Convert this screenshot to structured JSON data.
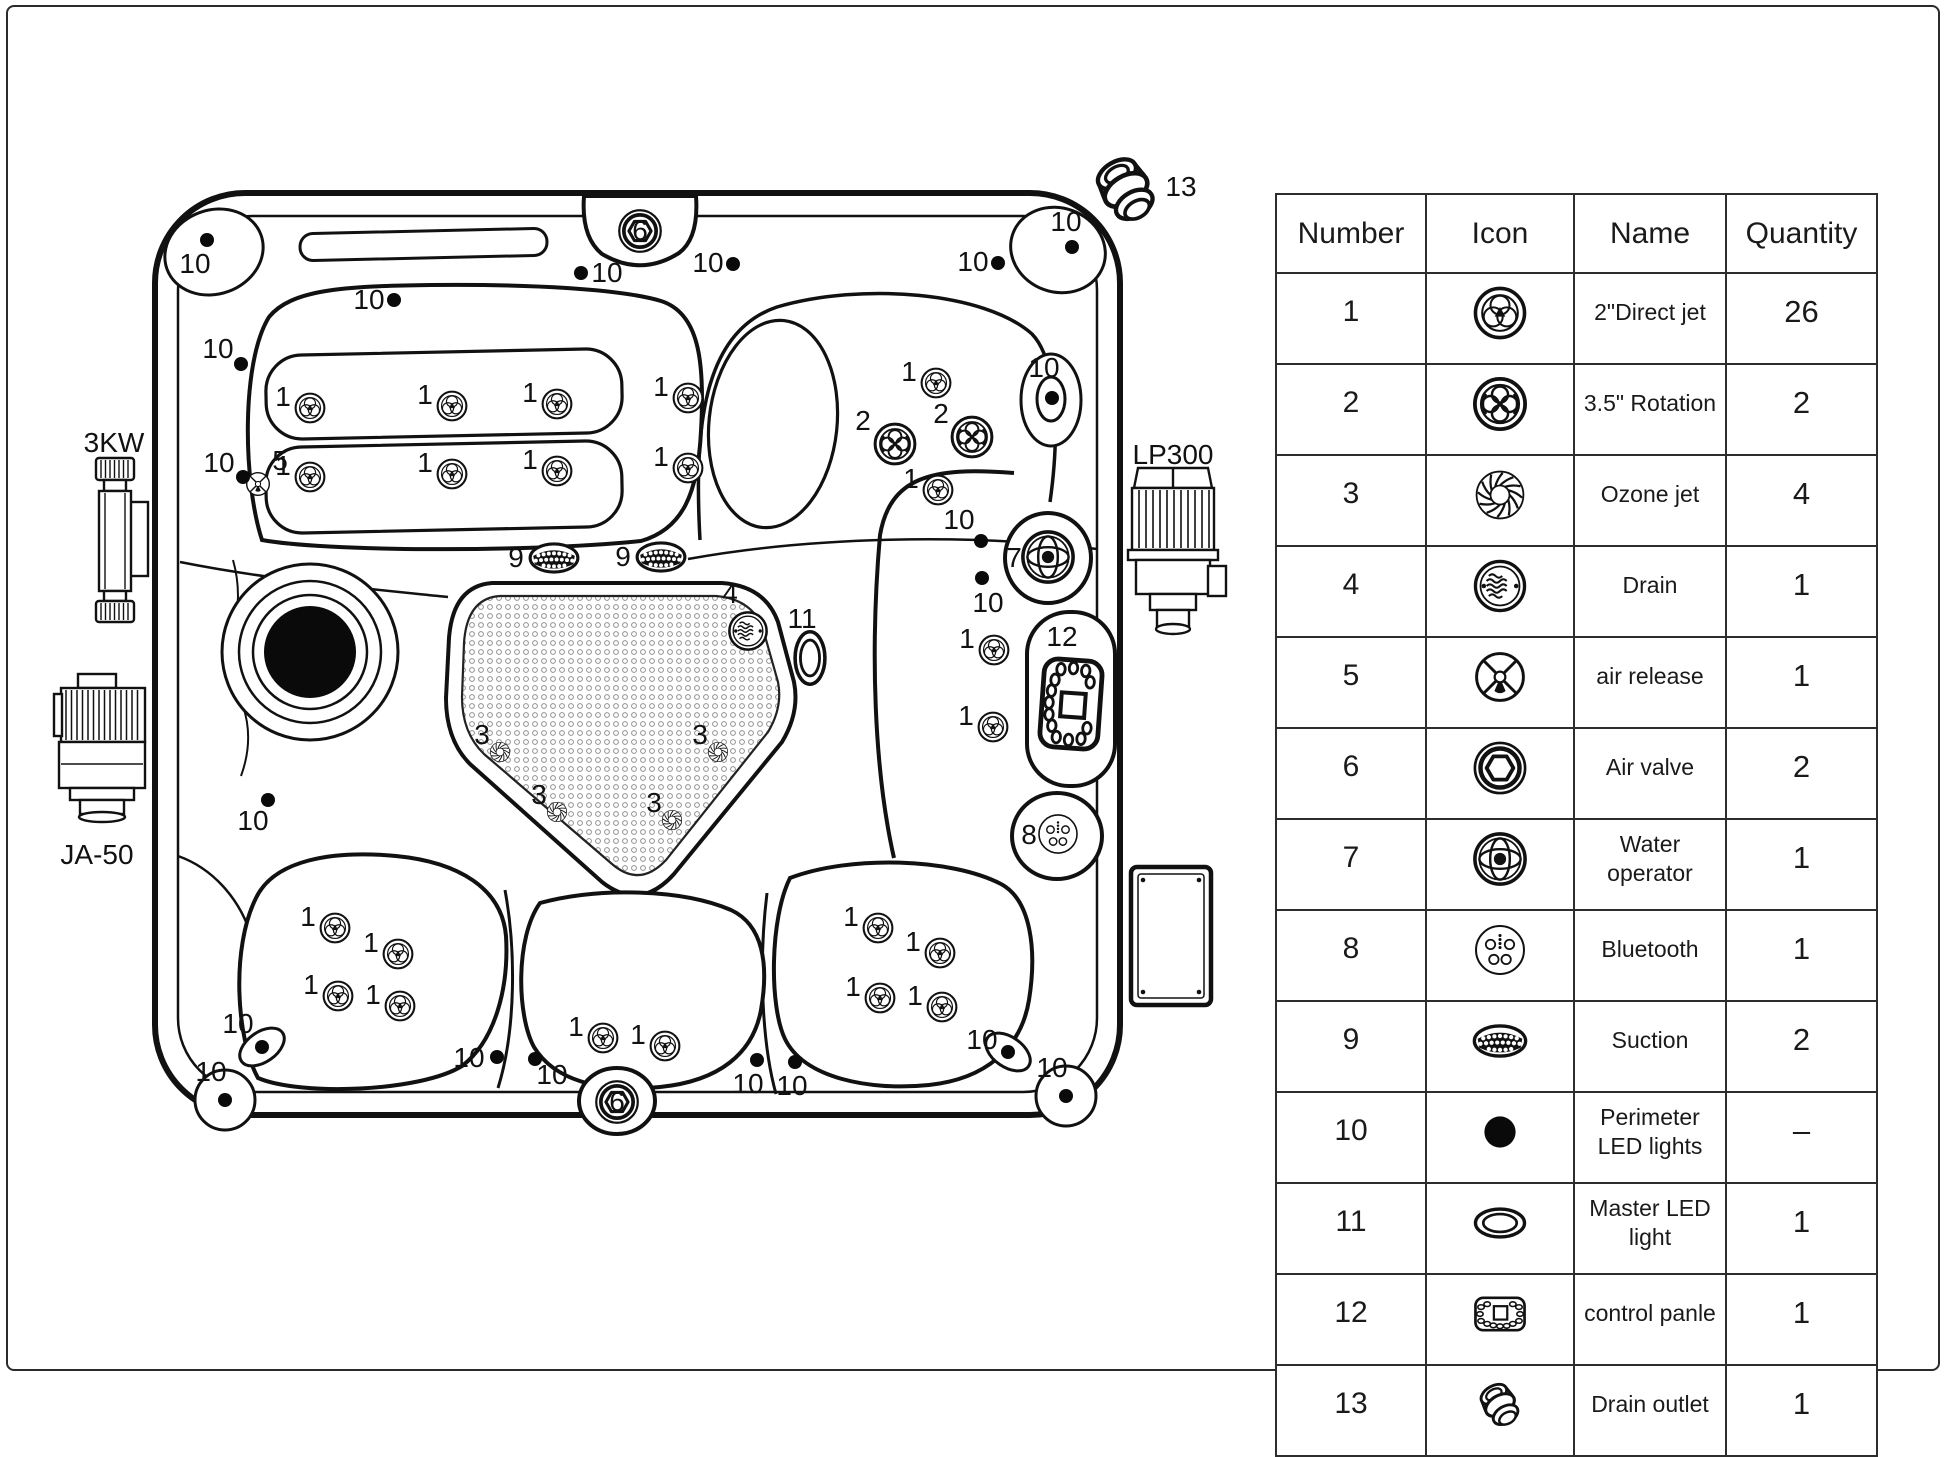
{
  "table": {
    "headers": [
      "Number",
      "Icon",
      "Name",
      "Quantity"
    ],
    "rows": [
      {
        "number": "1",
        "icon": "jet1",
        "name": "2\"Direct jet",
        "qty": "26"
      },
      {
        "number": "2",
        "icon": "jet2",
        "name": "3.5\" Rotation",
        "qty": "2"
      },
      {
        "number": "3",
        "icon": "ozone",
        "name": "Ozone jet",
        "qty": "4"
      },
      {
        "number": "4",
        "icon": "drain",
        "name": "Drain",
        "qty": "1"
      },
      {
        "number": "5",
        "icon": "airrelease",
        "name": "air release",
        "qty": "1"
      },
      {
        "number": "6",
        "icon": "airvalve",
        "name": "Air valve",
        "qty": "2"
      },
      {
        "number": "7",
        "icon": "wateroperator",
        "name": "Water operator",
        "qty": "1"
      },
      {
        "number": "8",
        "icon": "bluetooth",
        "name": "Bluetooth",
        "qty": "1"
      },
      {
        "number": "9",
        "icon": "suction",
        "name": "Suction",
        "qty": "2"
      },
      {
        "number": "10",
        "icon": "led-dot",
        "name": "Perimeter LED lights",
        "qty": "–"
      },
      {
        "number": "11",
        "icon": "master-led",
        "name": "Master LED light",
        "qty": "1"
      },
      {
        "number": "12",
        "icon": "panel",
        "name": "control panle",
        "qty": "1"
      },
      {
        "number": "13",
        "icon": "fitting",
        "name": "Drain outlet",
        "qty": "1"
      }
    ]
  },
  "diagram": {
    "side_labels": [
      "3KW",
      "JA-50",
      "LP300",
      "Electric box"
    ],
    "markers": [
      {
        "label": "3KW",
        "lx": 114,
        "ly": 452,
        "fs": 34,
        "name": "heater-3kw"
      },
      {
        "label": "JA-50",
        "lx": 97,
        "ly": 864,
        "fs": 34,
        "name": "pump-ja50"
      },
      {
        "label": "LP300",
        "lx": 1173,
        "ly": 464,
        "fs": 33,
        "name": "pump-lp300"
      },
      {
        "icon": "fitting",
        "x": 1126,
        "y": 190,
        "size": 86,
        "name": "drain-outlet",
        "label": "13",
        "lx": 1181,
        "ly": 196,
        "fs": 28
      },
      {
        "icon": "jet1",
        "x": 310,
        "y": 408,
        "size": 34,
        "label": "1",
        "lx": 283,
        "ly": 406
      },
      {
        "icon": "jet1",
        "x": 452,
        "y": 406,
        "size": 34,
        "label": "1",
        "lx": 425,
        "ly": 404
      },
      {
        "icon": "jet1",
        "x": 557,
        "y": 404,
        "size": 34,
        "label": "1",
        "lx": 530,
        "ly": 402
      },
      {
        "icon": "jet1",
        "x": 688,
        "y": 398,
        "size": 34,
        "label": "1",
        "lx": 661,
        "ly": 396
      },
      {
        "icon": "jet1",
        "x": 310,
        "y": 477,
        "size": 34,
        "label": "1",
        "lx": 283,
        "ly": 475
      },
      {
        "icon": "jet1",
        "x": 452,
        "y": 474,
        "size": 34,
        "label": "1",
        "lx": 425,
        "ly": 472
      },
      {
        "icon": "jet1",
        "x": 557,
        "y": 471,
        "size": 34,
        "label": "1",
        "lx": 530,
        "ly": 469
      },
      {
        "icon": "jet1",
        "x": 688,
        "y": 468,
        "size": 34,
        "label": "1",
        "lx": 661,
        "ly": 466
      },
      {
        "icon": "jet1",
        "x": 936,
        "y": 383,
        "size": 34,
        "label": "1",
        "lx": 909,
        "ly": 381
      },
      {
        "icon": "jet1",
        "x": 938,
        "y": 490,
        "size": 34,
        "label": "1",
        "lx": 911,
        "ly": 488
      },
      {
        "icon": "jet1",
        "x": 994,
        "y": 650,
        "size": 34,
        "label": "1",
        "lx": 967,
        "ly": 648
      },
      {
        "icon": "jet1",
        "x": 993,
        "y": 727,
        "size": 34,
        "label": "1",
        "lx": 966,
        "ly": 725
      },
      {
        "icon": "jet1",
        "x": 335,
        "y": 928,
        "size": 34,
        "label": "1",
        "lx": 308,
        "ly": 926
      },
      {
        "icon": "jet1",
        "x": 398,
        "y": 954,
        "size": 34,
        "label": "1",
        "lx": 371,
        "ly": 952
      },
      {
        "icon": "jet1",
        "x": 338,
        "y": 996,
        "size": 34,
        "label": "1",
        "lx": 311,
        "ly": 994
      },
      {
        "icon": "jet1",
        "x": 400,
        "y": 1006,
        "size": 34,
        "label": "1",
        "lx": 373,
        "ly": 1004
      },
      {
        "icon": "jet1",
        "x": 603,
        "y": 1038,
        "size": 34,
        "label": "1",
        "lx": 576,
        "ly": 1036
      },
      {
        "icon": "jet1",
        "x": 665,
        "y": 1046,
        "size": 34,
        "label": "1",
        "lx": 638,
        "ly": 1044
      },
      {
        "icon": "jet1",
        "x": 878,
        "y": 928,
        "size": 34,
        "label": "1",
        "lx": 851,
        "ly": 926
      },
      {
        "icon": "jet1",
        "x": 940,
        "y": 953,
        "size": 34,
        "label": "1",
        "lx": 913,
        "ly": 951
      },
      {
        "icon": "jet1",
        "x": 880,
        "y": 998,
        "size": 34,
        "label": "1",
        "lx": 853,
        "ly": 996
      },
      {
        "icon": "jet1",
        "x": 942,
        "y": 1007,
        "size": 34,
        "label": "1",
        "lx": 915,
        "ly": 1005
      },
      {
        "icon": "jet2",
        "x": 895,
        "y": 444,
        "size": 46,
        "label": "2",
        "lx": 863,
        "ly": 430
      },
      {
        "icon": "jet2",
        "x": 972,
        "y": 437,
        "size": 46,
        "label": "2",
        "lx": 941,
        "ly": 423
      },
      {
        "icon": "ozone",
        "x": 500,
        "y": 752,
        "size": 24,
        "label": "3",
        "lx": 482,
        "ly": 744
      },
      {
        "icon": "ozone",
        "x": 557,
        "y": 812,
        "size": 24,
        "label": "3",
        "lx": 539,
        "ly": 804
      },
      {
        "icon": "ozone",
        "x": 718,
        "y": 752,
        "size": 24,
        "label": "3",
        "lx": 700,
        "ly": 744
      },
      {
        "icon": "ozone",
        "x": 672,
        "y": 820,
        "size": 24,
        "label": "3",
        "lx": 654,
        "ly": 812
      },
      {
        "icon": "drain",
        "x": 748,
        "y": 631,
        "size": 44,
        "label": "4",
        "lx": 730,
        "ly": 603,
        "fs": 27
      },
      {
        "icon": "suction",
        "x": 554,
        "y": 558,
        "size": 54,
        "label": "9",
        "lx": 516,
        "ly": 567,
        "fs": 28
      },
      {
        "icon": "suction",
        "x": 661,
        "y": 557,
        "size": 54,
        "label": "9",
        "lx": 623,
        "ly": 566,
        "fs": 28
      },
      {
        "icon": "airrelease",
        "x": 258,
        "y": 484,
        "size": 28,
        "label": "5",
        "lx": 280,
        "ly": 470,
        "fs": 26
      },
      {
        "icon": "airvalve",
        "x": 640,
        "y": 231,
        "size": 48,
        "label": "6",
        "lx": 640,
        "ly": 240,
        "fs": 26
      },
      {
        "icon": "airvalve",
        "x": 617,
        "y": 1102,
        "size": 48,
        "label": "6",
        "lx": 617,
        "ly": 1111,
        "fs": 26
      },
      {
        "icon": "wateroperator",
        "x": 1048,
        "y": 557,
        "size": 58,
        "label": "7",
        "lx": 1014,
        "ly": 567,
        "fs": 30
      },
      {
        "icon": "bluetooth",
        "x": 1058,
        "y": 834,
        "size": 46,
        "label": "8",
        "lx": 1029,
        "ly": 844,
        "fs": 30
      },
      {
        "icon": "master-led",
        "x": 810,
        "y": 658,
        "size": 62,
        "rot": 90,
        "label": "11",
        "lx": 802,
        "ly": 628,
        "fs": 28
      },
      {
        "icon": "panel",
        "x": 1071,
        "y": 704,
        "size": 104,
        "rot": 94,
        "label": "12",
        "lx": 1062,
        "ly": 646,
        "fs": 28
      },
      {
        "dot": [
          207,
          240
        ],
        "label": "10",
        "lx": 195,
        "ly": 273
      },
      {
        "dot": [
          241,
          364
        ],
        "label": "10",
        "lx": 218,
        "ly": 358
      },
      {
        "dot": [
          243,
          477
        ],
        "label": "10",
        "lx": 219,
        "ly": 472
      },
      {
        "dot": [
          394,
          300
        ],
        "label": "10",
        "lx": 369,
        "ly": 309
      },
      {
        "dot": [
          581,
          273
        ],
        "label": "10",
        "lx": 607,
        "ly": 282
      },
      {
        "dot": [
          733,
          264
        ],
        "label": "10",
        "lx": 708,
        "ly": 272
      },
      {
        "dot": [
          998,
          263
        ],
        "label": "10",
        "lx": 973,
        "ly": 271
      },
      {
        "dot": [
          1072,
          247
        ],
        "label": "10",
        "lx": 1066,
        "ly": 231
      },
      {
        "dot": [
          1052,
          398
        ],
        "label": "10",
        "lx": 1044,
        "ly": 377
      },
      {
        "dot": [
          981,
          541
        ],
        "label": "10",
        "lx": 959,
        "ly": 529
      },
      {
        "dot": [
          982,
          578
        ],
        "label": "10",
        "lx": 988,
        "ly": 612
      },
      {
        "dot": [
          268,
          800
        ],
        "label": "10",
        "lx": 253,
        "ly": 830
      },
      {
        "dot": [
          262,
          1047
        ],
        "label": "10",
        "lx": 238,
        "ly": 1033
      },
      {
        "dot": [
          225,
          1100
        ],
        "label": "10",
        "lx": 211,
        "ly": 1081
      },
      {
        "dot": [
          497,
          1057
        ],
        "label": "10",
        "lx": 469,
        "ly": 1067
      },
      {
        "dot": [
          535,
          1059
        ],
        "label": "10",
        "lx": 552,
        "ly": 1084
      },
      {
        "dot": [
          757,
          1060
        ],
        "label": "10",
        "lx": 748,
        "ly": 1093
      },
      {
        "dot": [
          795,
          1062
        ],
        "label": "10",
        "lx": 792,
        "ly": 1095
      },
      {
        "dot": [
          1008,
          1052
        ],
        "label": "10",
        "lx": 982,
        "ly": 1049
      },
      {
        "dot": [
          1066,
          1096
        ],
        "label": "10",
        "lx": 1052,
        "ly": 1077
      }
    ]
  }
}
